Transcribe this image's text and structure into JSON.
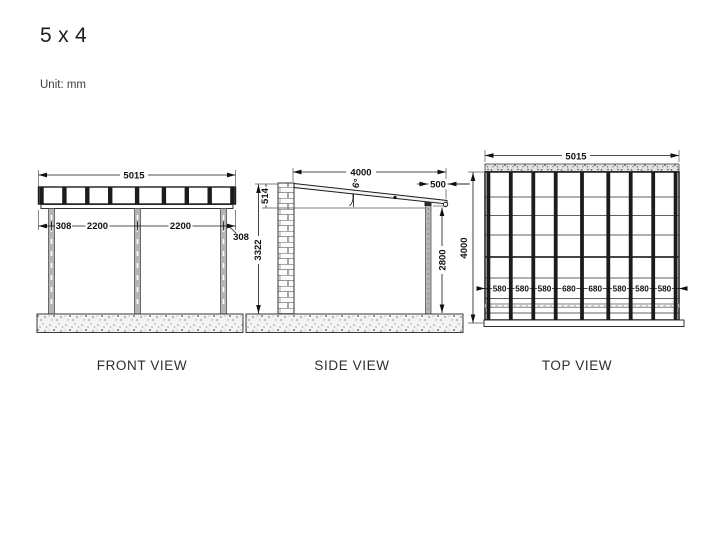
{
  "title": "5 x 4",
  "unit_label": "Unit: mm",
  "views": {
    "front": {
      "label": "FRONT VIEW",
      "dims": {
        "total_width": "5015",
        "left_offset": "308",
        "bay_left": "2200",
        "bay_right": "2200",
        "right_offset": "308"
      }
    },
    "side": {
      "label": "SIDE VIEW",
      "dims": {
        "depth": "4000",
        "overhang": "500",
        "fascia_height": "514",
        "wall_height": "3322",
        "post_height": "2800",
        "roof_angle": "6°"
      }
    },
    "top": {
      "label": "TOP VIEW",
      "dims": {
        "total_width": "5015",
        "depth": "4000"
      },
      "rafter_spacings": [
        "580",
        "580",
        "580",
        "680",
        "680",
        "580",
        "580",
        "580"
      ]
    }
  }
}
